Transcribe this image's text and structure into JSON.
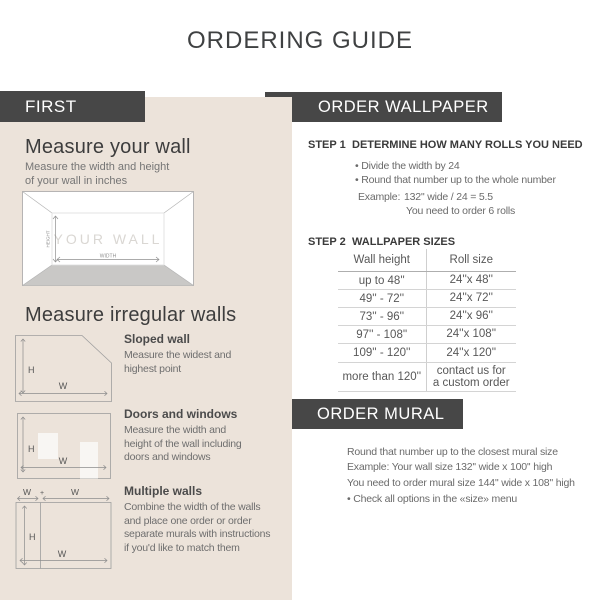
{
  "title": "ORDERING GUIDE",
  "colors": {
    "accent_dark": "#474747",
    "panel_beige": "#ece3da"
  },
  "left": {
    "band_label": "FIRST",
    "measure_wall": {
      "heading": "Measure your wall",
      "subtext": "Measure the width and height\nof your wall in inches",
      "diagram": {
        "wall_label": "YOUR WALL",
        "height_label": "HEIGHT",
        "width_label": "WIDTH"
      }
    },
    "irregular": {
      "heading": "Measure irregular walls",
      "sloped": {
        "label": "Sloped wall",
        "text": "Measure the widest and\nhighest point",
        "h": "H",
        "w": "W"
      },
      "doors": {
        "label": "Doors and windows",
        "text": "Measure the width and\nheight of the wall including\ndoors and windows",
        "h": "H",
        "w": "W"
      },
      "multiple": {
        "label": "Multiple walls",
        "text": "Combine the width of the walls\nand place one order or order\nseparate murals with instructions\nif you'd like to match them",
        "top_w1": "W",
        "plus": "+",
        "top_w2": "W",
        "h": "H",
        "w": "W"
      }
    }
  },
  "wallpaper": {
    "band_label": "ORDER WALLPAPER",
    "step1": {
      "label": "STEP 1",
      "title": "DETERMINE HOW MANY ROLLS YOU NEED",
      "bullets": [
        "• Divide the width by 24",
        "• Round that number up to the whole number"
      ],
      "example_label": "Example:",
      "example_value": "132'' wide / 24 = 5.5",
      "example_result": "You need to order 6 rolls"
    },
    "step2": {
      "label": "STEP 2",
      "title": "WALLPAPER SIZES",
      "table": {
        "col1": "Wall height",
        "col2": "Roll size",
        "rows": [
          [
            "up to 48''",
            "24''x 48''"
          ],
          [
            "49'' - 72''",
            "24''x 72''"
          ],
          [
            "73'' - 96''",
            "24''x 96''"
          ],
          [
            "97'' - 108''",
            "24''x 108''"
          ],
          [
            "109'' - 120''",
            "24''x 120''"
          ],
          [
            "more than 120''",
            "contact us for\na custom order"
          ]
        ]
      }
    }
  },
  "mural": {
    "band_label": "ORDER MURAL",
    "lines": [
      "Round that number up to the closest mural size",
      "Example: Your wall size 132'' wide x 100'' high",
      "You need to order mural size 144'' wide x 108'' high",
      "• Check all options in the «size» menu"
    ]
  }
}
